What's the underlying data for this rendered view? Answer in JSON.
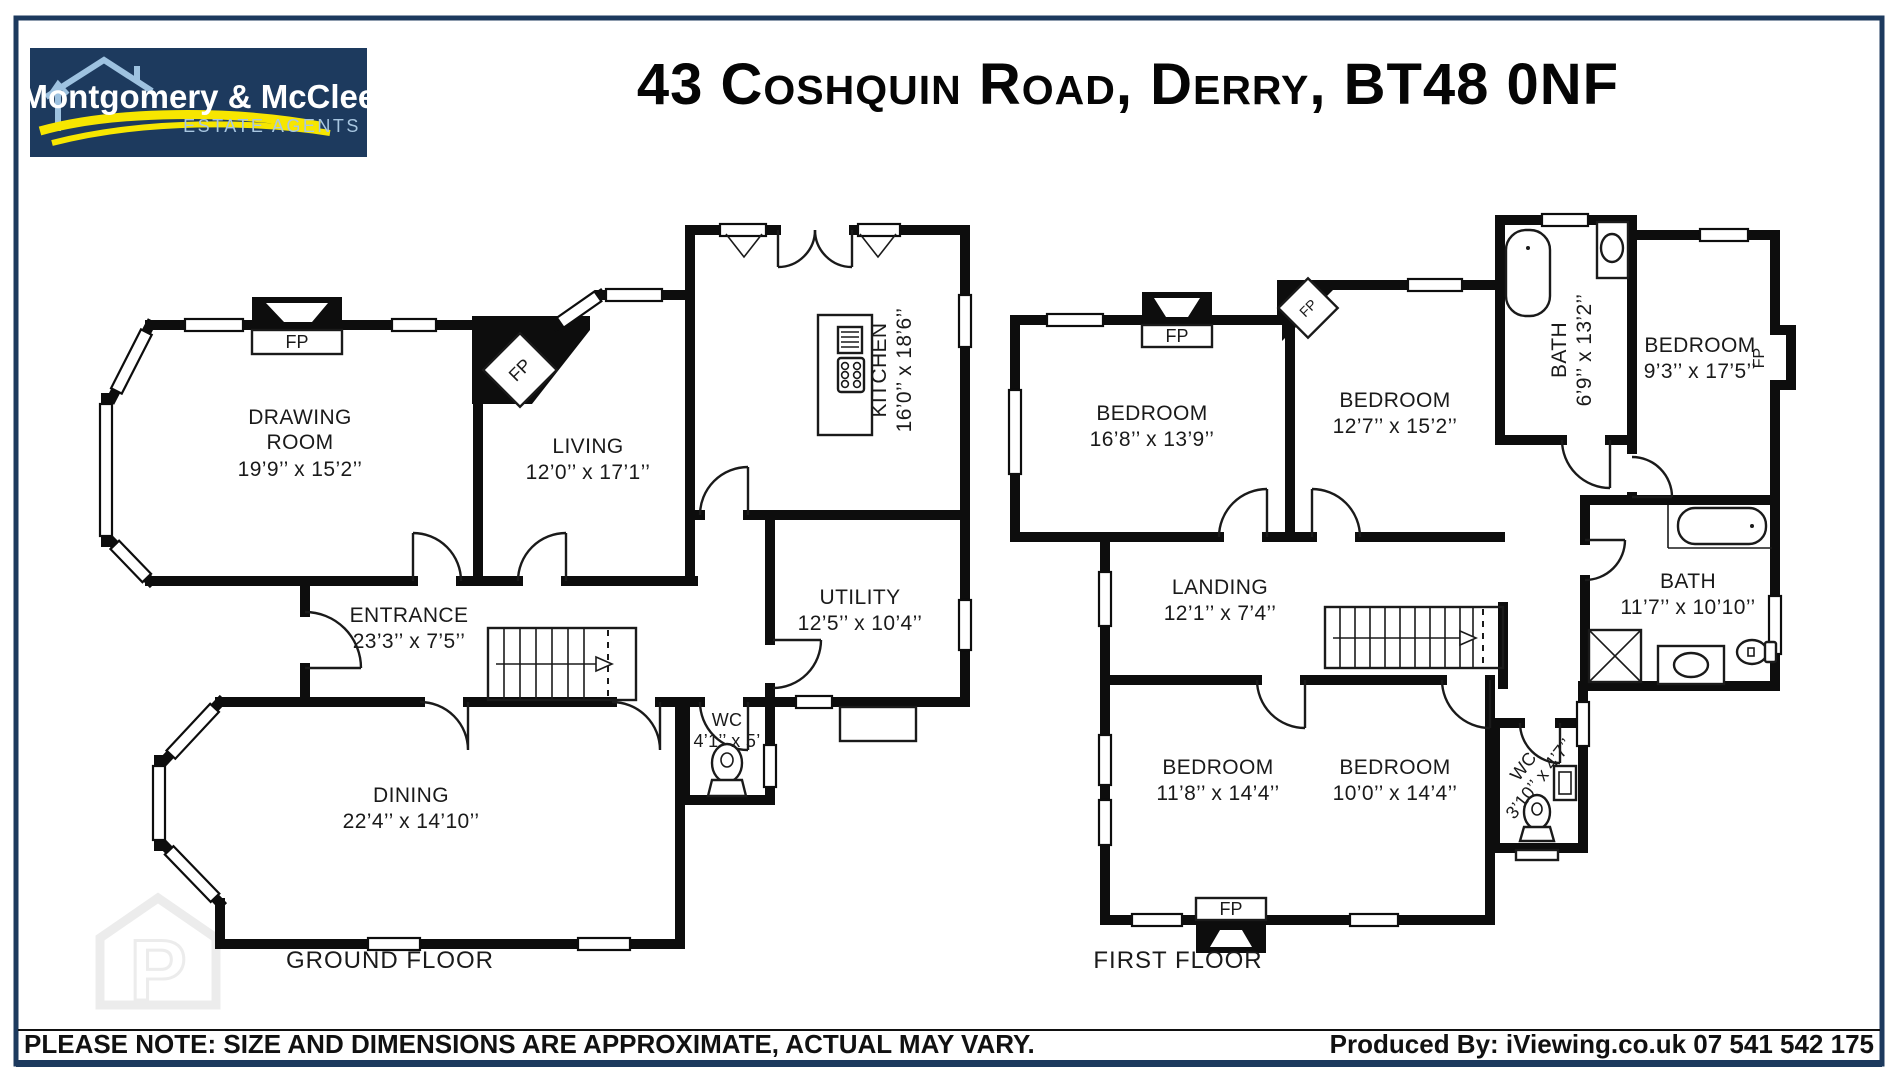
{
  "header": {
    "logo": {
      "name": "Montgomery & McCleery",
      "tagline": "ESTATE AGENTS"
    },
    "title": "43 Coshquin Road, Derry, BT48 0NF"
  },
  "colors": {
    "navy": "#1d3a5e",
    "light_blue": "#9ec2e0",
    "yellow": "#f7e600",
    "wall_black": "#0d0d0d",
    "watermark_gray": "#ececec"
  },
  "fireplace_label": "FP",
  "ground_floor": {
    "label": "GROUND FLOOR",
    "rooms": {
      "drawing_room": {
        "line1": "DRAWING",
        "line2": "ROOM",
        "dims": "19’9’’ x 15’2’’"
      },
      "living": {
        "name": "LIVING",
        "dims": "12’0’’ x 17’1’’"
      },
      "kitchen": {
        "name": "KITCHEN",
        "dims": "16’0’’ x 18’6’’"
      },
      "entrance": {
        "name": "ENTRANCE",
        "dims": "23’3’’ x 7’5’’"
      },
      "utility": {
        "name": "UTILITY",
        "dims": "12’5’’ x 10’4’’"
      },
      "wc": {
        "name": "WC",
        "dims": "4’1’’ x 5’"
      },
      "dining": {
        "name": "DINING",
        "dims": "22’4’’ x 14’10’’"
      }
    }
  },
  "first_floor": {
    "label": "FIRST FLOOR",
    "rooms": {
      "bedroom_1": {
        "name": "BEDROOM",
        "dims": "16’8’’ x 13’9’’"
      },
      "bedroom_2": {
        "name": "BEDROOM",
        "dims": "12’7’’ x 15’2’’"
      },
      "bath_1": {
        "name": "BATH",
        "dims": "6’9’’ x 13’2’’"
      },
      "bedroom_3": {
        "name": "BEDROOM",
        "dims": "9’3’’ x 17’5’’"
      },
      "landing": {
        "name": "LANDING",
        "dims": "12’1’’ x 7’4’’"
      },
      "bath_2": {
        "name": "BATH",
        "dims": "11’7’’ x 10’10’’"
      },
      "bedroom_4": {
        "name": "BEDROOM",
        "dims": "11’8’’ x 14’4’’"
      },
      "bedroom_5": {
        "name": "BEDROOM",
        "dims": "10’0’’ x 14’4’’"
      },
      "wc": {
        "name": "WC",
        "dims": "3’10’’ x 4’7’’"
      }
    }
  },
  "footer": {
    "note": "PLEASE NOTE: SIZE AND DIMENSIONS ARE APPROXIMATE, ACTUAL MAY VARY.",
    "produced_by": "Produced By: iViewing.co.uk 07 541 542 175"
  }
}
